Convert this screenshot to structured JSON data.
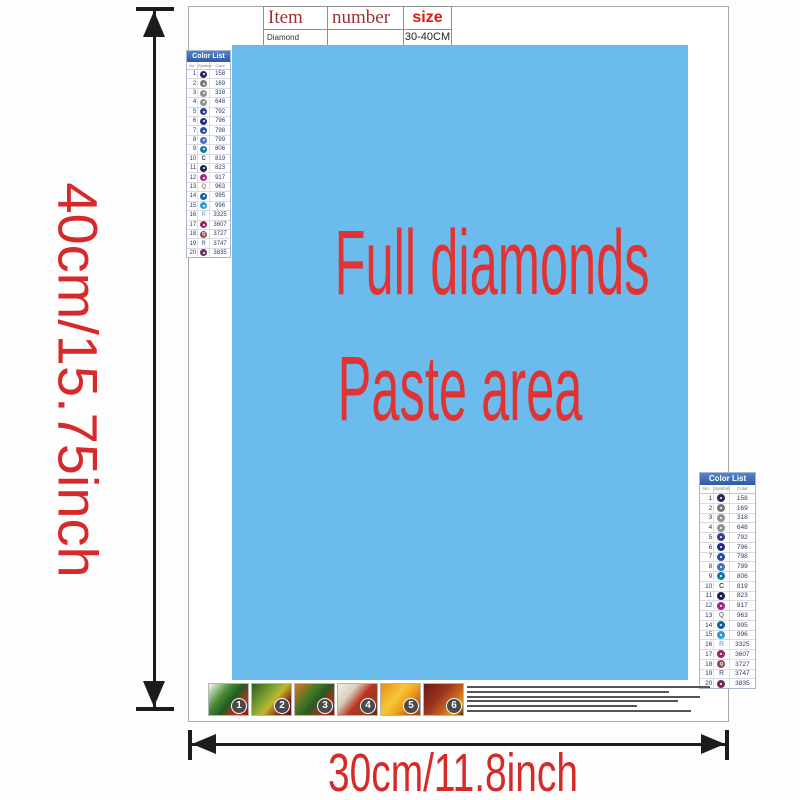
{
  "item_table": {
    "headers": {
      "item": "Item",
      "number": "number",
      "size": "size"
    },
    "row": {
      "item": "Diamond painting",
      "number": "",
      "size": "30-40CM"
    },
    "header_color": "#993230",
    "size_color": "#ea1410"
  },
  "canvas": {
    "line1": "Full diamonds",
    "line2": "Paste area",
    "bg_color": "#6bbcec",
    "text_color": "#e23333"
  },
  "dimension_labels": {
    "height": "40cm/15.75inch",
    "width": "30cm/11.8inch",
    "color": "#d62a2a"
  },
  "color_list": {
    "title": "Color List",
    "columns": [
      "No.",
      "Symbol",
      "Color"
    ],
    "header_bg_top": "#5585cc",
    "header_bg_bottom": "#2e5aa4",
    "rows": [
      {
        "no": "1",
        "code": "158",
        "type": "circle",
        "color": "#262a5e",
        "letter": ""
      },
      {
        "no": "2",
        "code": "169",
        "type": "circle",
        "color": "#75797c",
        "letter": ""
      },
      {
        "no": "3",
        "code": "318",
        "type": "circle",
        "color": "#8e9194",
        "letter": ""
      },
      {
        "no": "4",
        "code": "648",
        "type": "circle",
        "color": "#8f948c",
        "letter": ""
      },
      {
        "no": "5",
        "code": "792",
        "type": "circle",
        "color": "#333f8f",
        "letter": ""
      },
      {
        "no": "6",
        "code": "796",
        "type": "circle",
        "color": "#232f7d",
        "letter": ""
      },
      {
        "no": "7",
        "code": "798",
        "type": "circle",
        "color": "#2b4ea5",
        "letter": ""
      },
      {
        "no": "8",
        "code": "799",
        "type": "circle",
        "color": "#4a6fbe",
        "letter": ""
      },
      {
        "no": "9",
        "code": "806",
        "type": "circle",
        "color": "#1579a6",
        "letter": ""
      },
      {
        "no": "10",
        "code": "819",
        "type": "letter",
        "color": "#444444",
        "letter": "C"
      },
      {
        "no": "11",
        "code": "823",
        "type": "circle",
        "color": "#1a2350",
        "letter": ""
      },
      {
        "no": "12",
        "code": "917",
        "type": "circle",
        "color": "#a02882",
        "letter": ""
      },
      {
        "no": "13",
        "code": "963",
        "type": "letter",
        "color": "#8a8a8a",
        "letter": "Q"
      },
      {
        "no": "14",
        "code": "995",
        "type": "circle",
        "color": "#1461aa",
        "letter": ""
      },
      {
        "no": "15",
        "code": "996",
        "type": "circle",
        "color": "#2f9bd8",
        "letter": ""
      },
      {
        "no": "16",
        "code": "3325",
        "type": "letter",
        "color": "#8db8dd",
        "letter": "R"
      },
      {
        "no": "17",
        "code": "3607",
        "type": "circle",
        "color": "#97266f",
        "letter": ""
      },
      {
        "no": "18",
        "code": "3727",
        "type": "circle",
        "color": "#93455c",
        "letter": "Q"
      },
      {
        "no": "19",
        "code": "3747",
        "type": "letter",
        "color": "#7a84a8",
        "letter": "R"
      },
      {
        "no": "20",
        "code": "3835",
        "type": "circle",
        "color": "#6e2d61",
        "letter": ""
      }
    ]
  },
  "steps": [
    {
      "number": "1",
      "gradient": "linear-gradient(130deg,#f8f8f4 0%,#4a8a30 35%,#1e5c22 55%,#c43020 80%,#8a1a10 100%)"
    },
    {
      "number": "2",
      "gradient": "linear-gradient(130deg,#2a5c20 0%,#88a832 40%,#c0b82a 55%,#8a2015 80%,#5c130c 100%)"
    },
    {
      "number": "3",
      "gradient": "linear-gradient(130deg,#e07020 0%,#4a7a28 35%,#2a5a20 55%,#b02a18 80%,#7a1a10 100%)"
    },
    {
      "number": "4",
      "gradient": "linear-gradient(130deg,#f2ece0 0%,#d8d0c0 30%,#b83420 55%,#8a4028 80%,#5c2a18 100%)"
    },
    {
      "number": "5",
      "gradient": "linear-gradient(130deg,#e88c1a 0%,#f5c838 40%,#f0a020 60%,#c05a10 85%,#904008 100%)"
    },
    {
      "number": "6",
      "gradient": "linear-gradient(130deg,#6e1a10 0%,#9a3520 40%,#c8641e 65%,#e0a020 85%,#4a140c 100%)"
    }
  ],
  "fine_print": {
    "line_widths": [
      100,
      83,
      96,
      87,
      70,
      92
    ]
  }
}
